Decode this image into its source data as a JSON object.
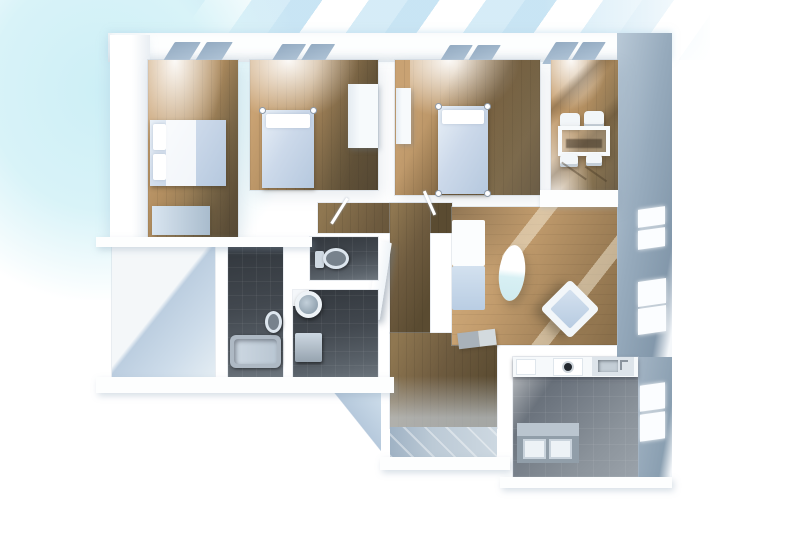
{
  "scene": {
    "title": "3D rendered apartment floor plan, top-down view",
    "style": "architectural 3d render",
    "background": "#ffffff"
  },
  "palette": {
    "glow_cyan": "#d2f1f7",
    "beam_blue": "#bfe0f2",
    "wall_white": "#fdfefe",
    "wall_face_grey": "#97abbd",
    "wood_light": "#c9a273",
    "wood_dark": "#6a5c46",
    "corridor_wood": "#6e5b3f",
    "living_wood": "#c29c6d",
    "tile_dark": "#42484f",
    "tile_kitchen": "#6e7680",
    "tile_entrance": "#bccad6",
    "furniture_white": "#f4f7fa",
    "furniture_blue": "#b9cde3",
    "shadow_blue": "#b6c9dc"
  },
  "rooms": {
    "bedroom1": {
      "label": "Bedroom 1 — double bed and dresser, wood floor",
      "windows": 2
    },
    "bedroom2": {
      "label": "Bedroom 2 — single bed and wardrobe, wood floor",
      "windows": 2
    },
    "bedroom3": {
      "label": "Bedroom 3 — single bed, wood floor",
      "windows": 2
    },
    "dining": {
      "label": "Dining room — table with four chairs, wood floor",
      "windows": 2
    },
    "living": {
      "label": "Living room — sofa, oval table, armchair, laptop on floor",
      "windows": 4
    },
    "hallway": {
      "label": "Hallway — wood floor with open door",
      "windows": 0
    },
    "entrance": {
      "label": "Entrance — light tile floor",
      "windows": 0
    },
    "nook": {
      "label": "Empty white room with cast shadow",
      "windows": 0
    },
    "bathroom1": {
      "label": "Bathroom — bathtub and bidet, dark tile",
      "windows": 0
    },
    "wc": {
      "label": "WC — toilet, dark tile",
      "windows": 0
    },
    "bathroom2": {
      "label": "Washroom — round sink and washing machine, dark tile",
      "windows": 0
    },
    "kitchen": {
      "label": "Kitchen — counter with appliances and island unit, grey tile",
      "windows": 2
    }
  },
  "furniture": {
    "double_bed": "double bed with white pillows and blue blanket",
    "single_bed": "single bed with corner posts",
    "dresser": "low dresser",
    "wardrobe": "white wardrobe",
    "dining_table": "white dining table",
    "dining_chairs": "four white chairs",
    "sofa": "white sofa with blue seat",
    "oval_table": "oval glass table",
    "armchair": "armchair rotated 45 degrees",
    "laptop": "laptop on floor",
    "bathtub": "bathtub",
    "bidet": "bidet",
    "toilet": "toilet with tank",
    "round_sink": "round pedestal sink",
    "washing_machine": "washing machine",
    "kitchen_counter": "kitchen counter with fridge, washer, sink",
    "kitchen_island": "kitchen island with two door panels",
    "open_door": "open door panel in hallway"
  }
}
